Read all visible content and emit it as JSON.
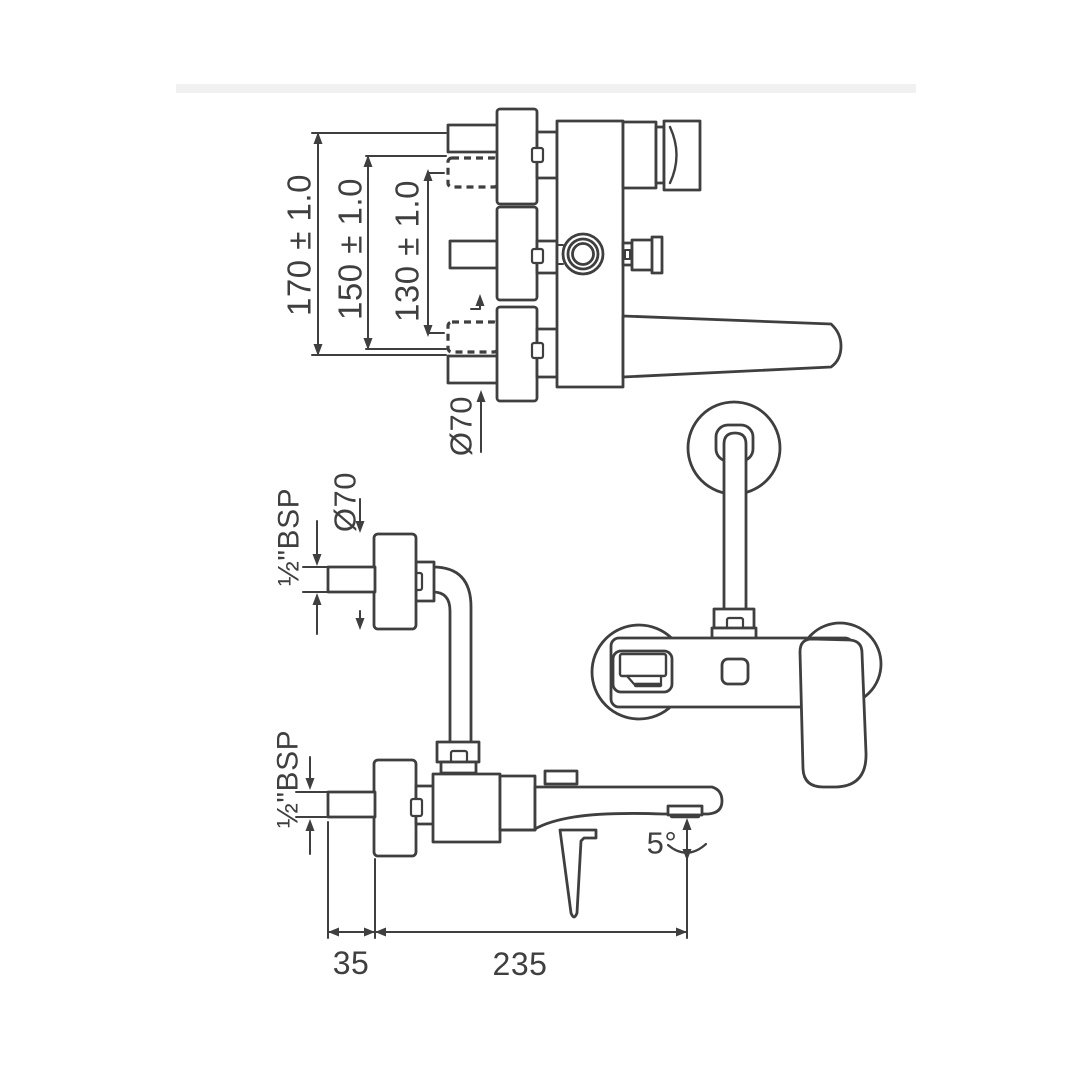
{
  "page": {
    "background_color": "#ffffff",
    "ink_color": "#3f3f3f",
    "band_color": "#f1f1f1"
  },
  "top_view": {
    "dim_outer": "170 ± 1.0",
    "dim_middle": "150 ± 1.0",
    "dim_inner": "130 ± 1.0",
    "dim_flange_diameter": "Ø70"
  },
  "wall_union_view": {
    "dim_flange_diameter": "Ø70",
    "dim_thread": "½\"BSP"
  },
  "side_view": {
    "dim_thread": "½\"BSP",
    "dim_wall_offset": "35",
    "dim_spout_reach": "235",
    "dim_spout_angle": "5°"
  }
}
